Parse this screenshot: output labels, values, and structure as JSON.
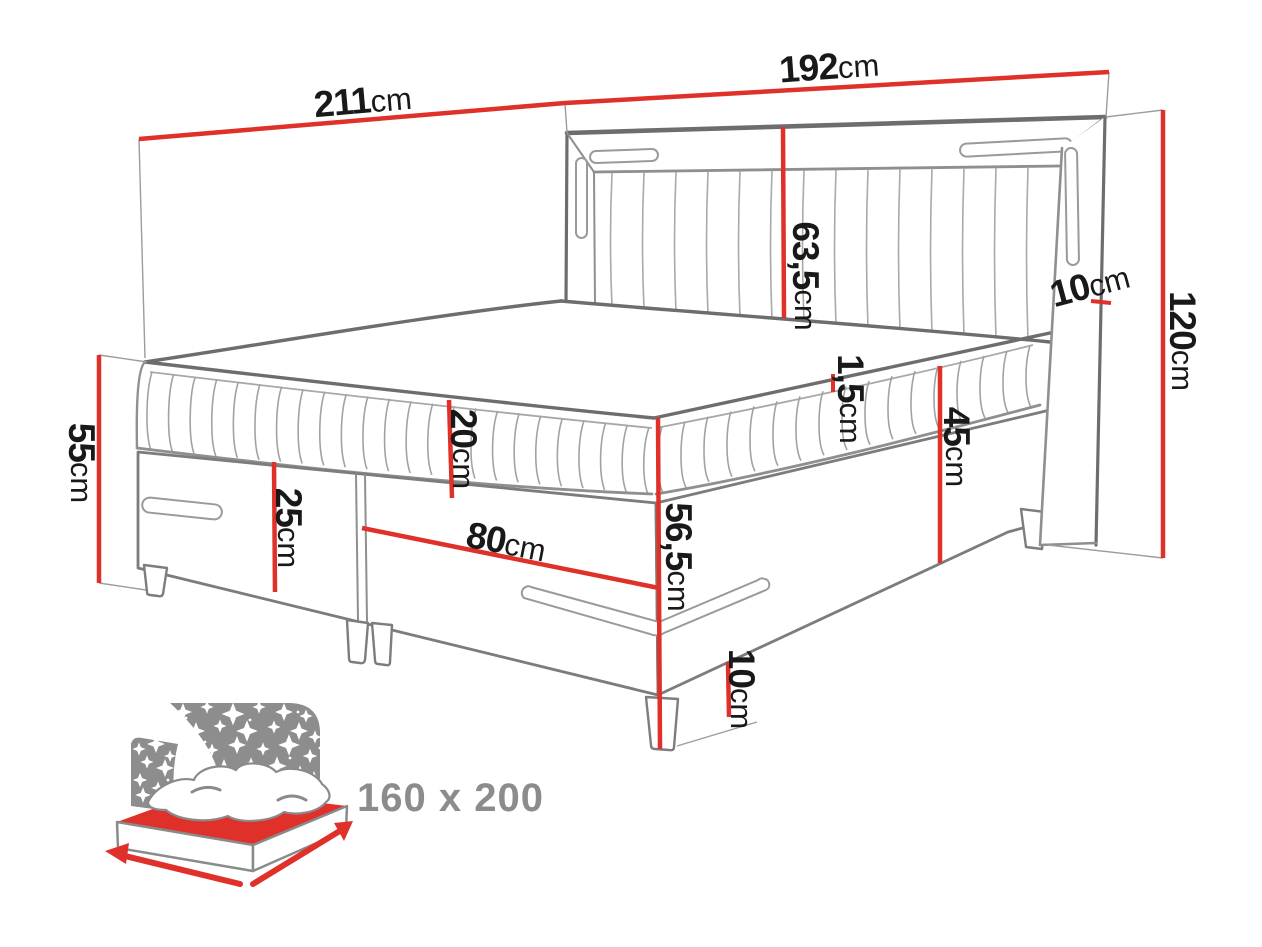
{
  "diagram": {
    "kind": "boxspring-bed-dimension-drawing",
    "unit": "cm"
  },
  "dims": {
    "length_top": {
      "value": "211",
      "unit": "cm"
    },
    "width_top": {
      "value": "192",
      "unit": "cm"
    },
    "headboard_panel": {
      "value": "63,5",
      "unit": "cm"
    },
    "wing_depth": {
      "value": "10",
      "unit": "cm"
    },
    "headboard_height": {
      "value": "120",
      "unit": "cm"
    },
    "mattress_lip": {
      "value": "1,5",
      "unit": "cm"
    },
    "side_height": {
      "value": "45",
      "unit": "cm"
    },
    "corner_height": {
      "value": "56,5",
      "unit": "cm"
    },
    "mattress_thickness": {
      "value": "20",
      "unit": "cm"
    },
    "base_height": {
      "value": "25",
      "unit": "cm"
    },
    "drawer_span": {
      "value": "80",
      "unit": "cm"
    },
    "foot_end_height": {
      "value": "55",
      "unit": "cm"
    },
    "leg_height": {
      "value": "10",
      "unit": "cm"
    }
  },
  "badge": {
    "size_label": "160 x 200"
  },
  "colors": {
    "dimension_red": "#e0302a",
    "drawing_dark_gray": "#6d6d6d",
    "drawing_mid_gray": "#8f8f8f",
    "drawing_light_gray": "#a8a8a8",
    "label_black": "#191919",
    "icon_gray": "#8d8d8d",
    "badge_text_gray": "#8c8c8c",
    "background": "#ffffff"
  }
}
